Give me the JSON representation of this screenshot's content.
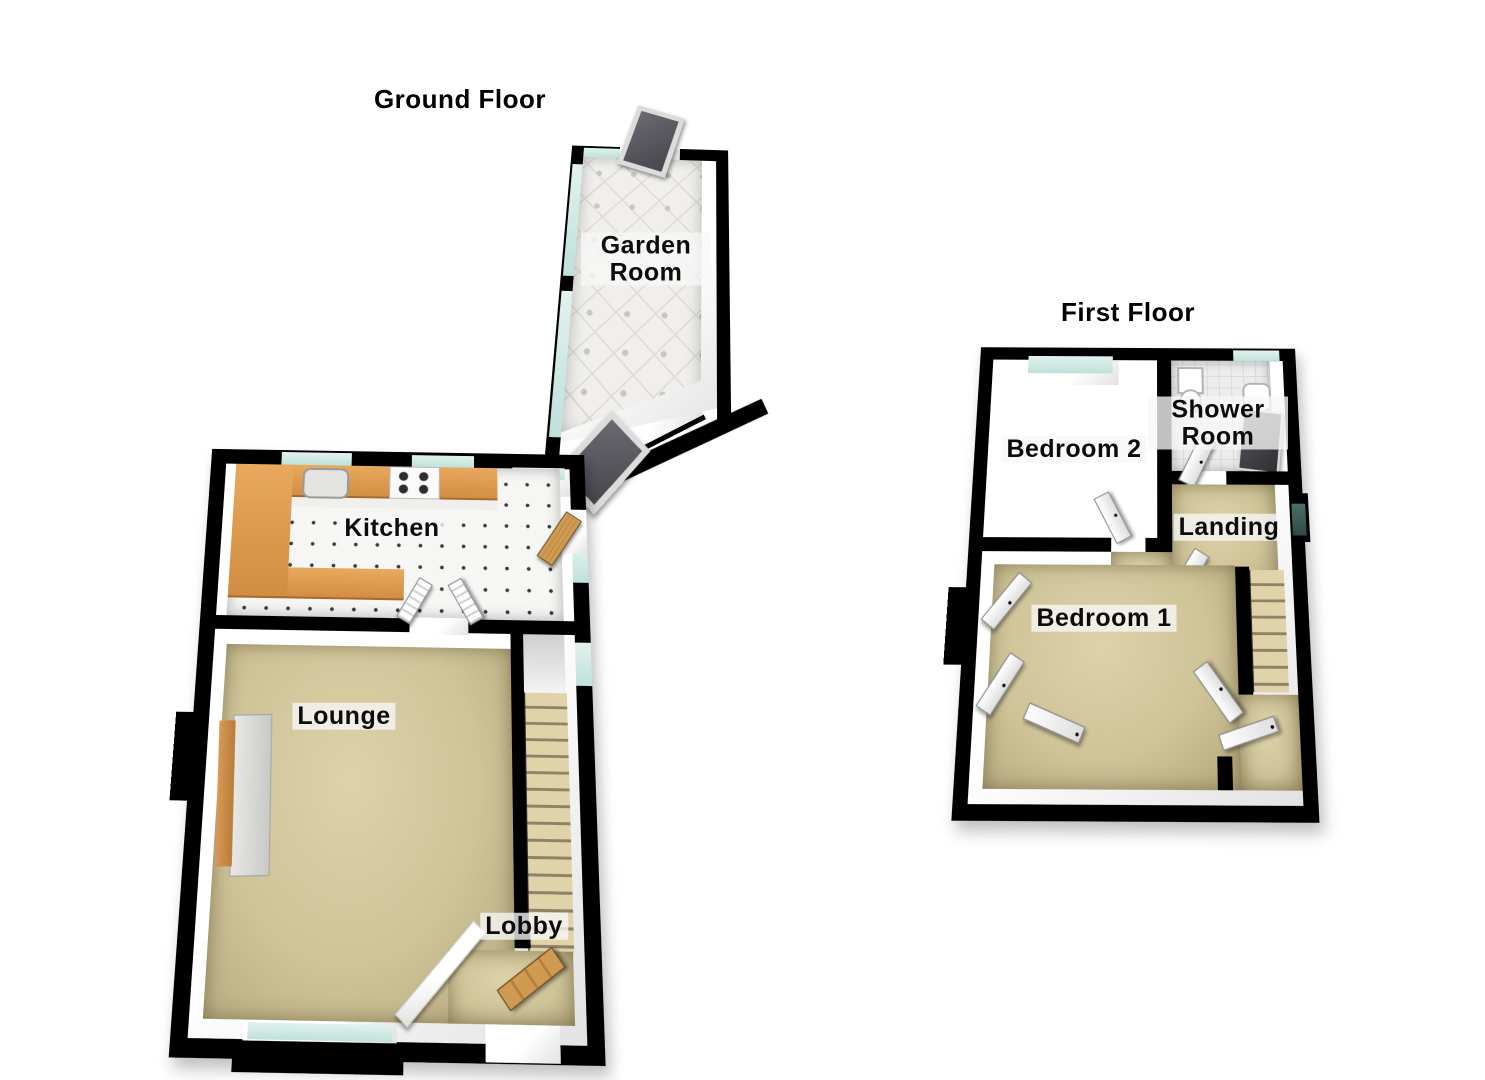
{
  "titles": {
    "ground": "Ground Floor",
    "first": "First Floor"
  },
  "rooms": {
    "garden_room": "Garden Room",
    "kitchen": "Kitchen",
    "lounge": "Lounge",
    "lobby": "Lobby",
    "bedroom2": "Bedroom 2",
    "shower_room": "Shower Room",
    "landing": "Landing",
    "bedroom1": "Bedroom 1"
  },
  "colors": {
    "wall": "#000000",
    "wall_face": "#ffffff",
    "carpet": "#cfc398",
    "kitchen_counter": "#d98f45",
    "wood_door": "#c8954f",
    "window_glass": "#cfe9e5",
    "landing_window_glass": "#3f6561",
    "garden_tile": "#f0efec",
    "kitchen_tile": "#f6f6f4",
    "shower_tile": "#eceded",
    "shower_enclosure": "#46464c",
    "stair_tread": "#e0d3a9",
    "label_background": "rgba(247,247,247,0.78)",
    "label_text": "#0c0c0c"
  }
}
